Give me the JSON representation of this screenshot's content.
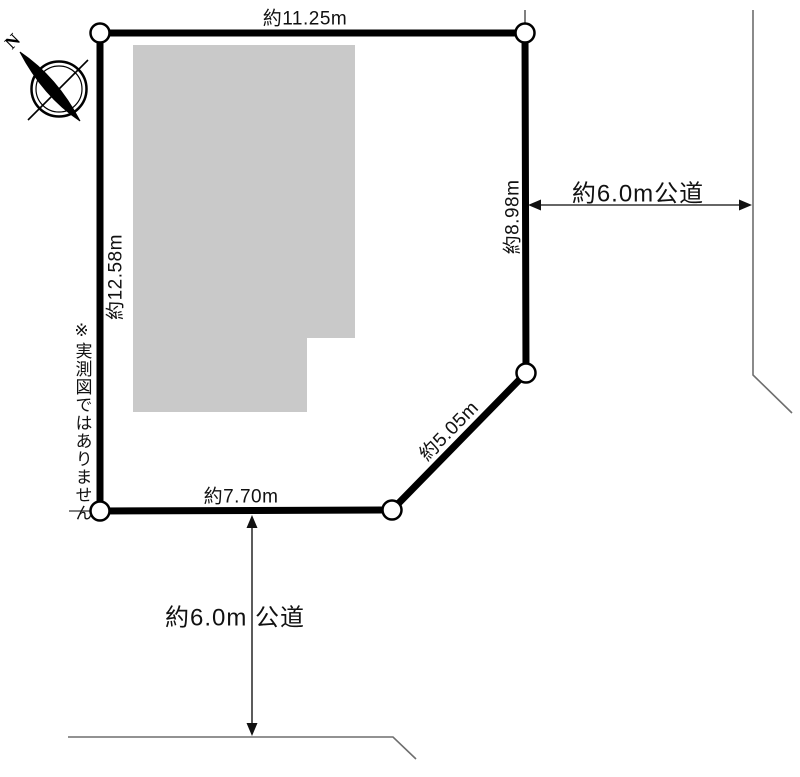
{
  "diagram": {
    "type": "land-plot-survey-figure",
    "compass": {
      "label": "N"
    },
    "disclaimer": "※実測図ではありません",
    "dimensions": {
      "top": "約11.25m",
      "left": "約12.58m",
      "right": "約8.98m",
      "diagonal": "約5.05m",
      "bottom": "約7.70m"
    },
    "roads": {
      "right_label": "約6.0m公道",
      "bottom_label": "約6.0m 公道"
    },
    "colors": {
      "plot_outline": "#000000",
      "building_fill": "#c9c9c9",
      "road_line": "#6e6e6e",
      "arrow": "#333333",
      "text": "#111111"
    }
  }
}
